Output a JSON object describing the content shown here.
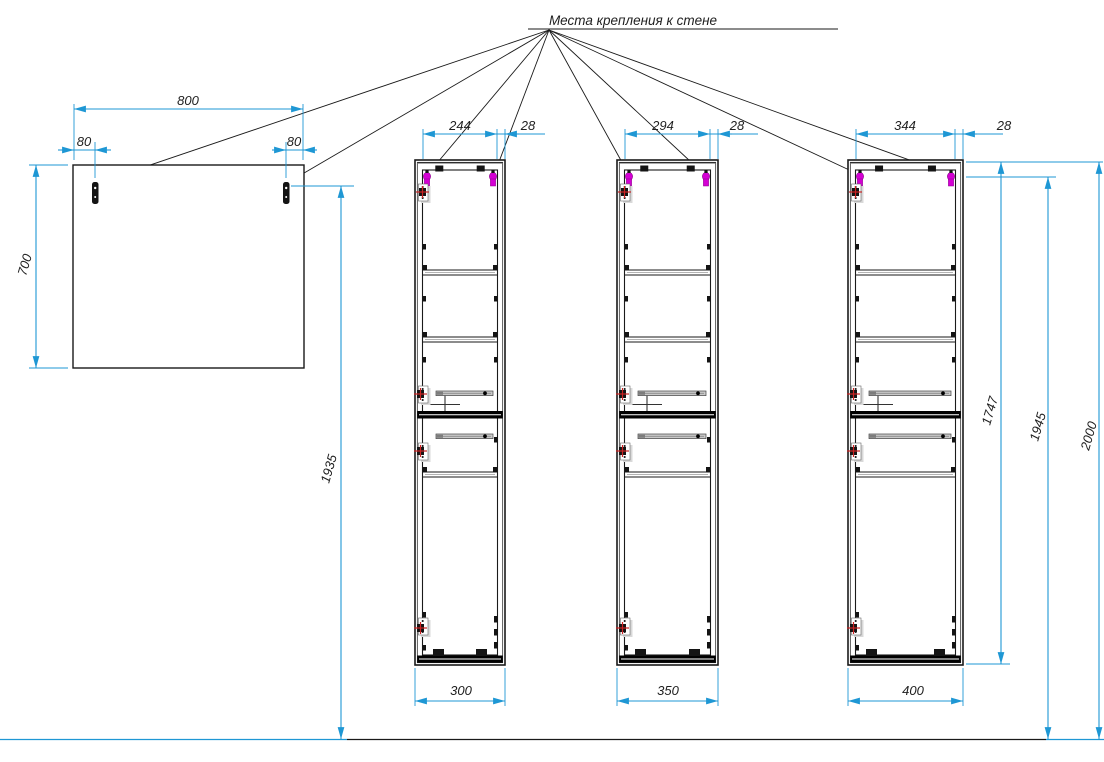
{
  "title": "Места крепления к стене",
  "colors": {
    "dimension_line": "#1e97d4",
    "drawing_line": "#1a1a1a",
    "hinge_fitting": "#d400d4",
    "fastener_marker": "#cc2222",
    "slide_fill": "#c9c9c9"
  },
  "mirror": {
    "width": "800",
    "height": "700",
    "bracket_offset_left": "80",
    "bracket_offset_right": "80",
    "bracket_to_floor": "1935"
  },
  "cabinets": [
    {
      "inner_width": "244",
      "side_wall": "28",
      "overall_width": "300"
    },
    {
      "inner_width": "294",
      "side_wall": "28",
      "overall_width": "350"
    },
    {
      "inner_width": "344",
      "side_wall": "28",
      "overall_width": "400",
      "carcass_height": "1747",
      "bracket_to_floor": "1945",
      "top_to_floor": "2000"
    }
  ]
}
